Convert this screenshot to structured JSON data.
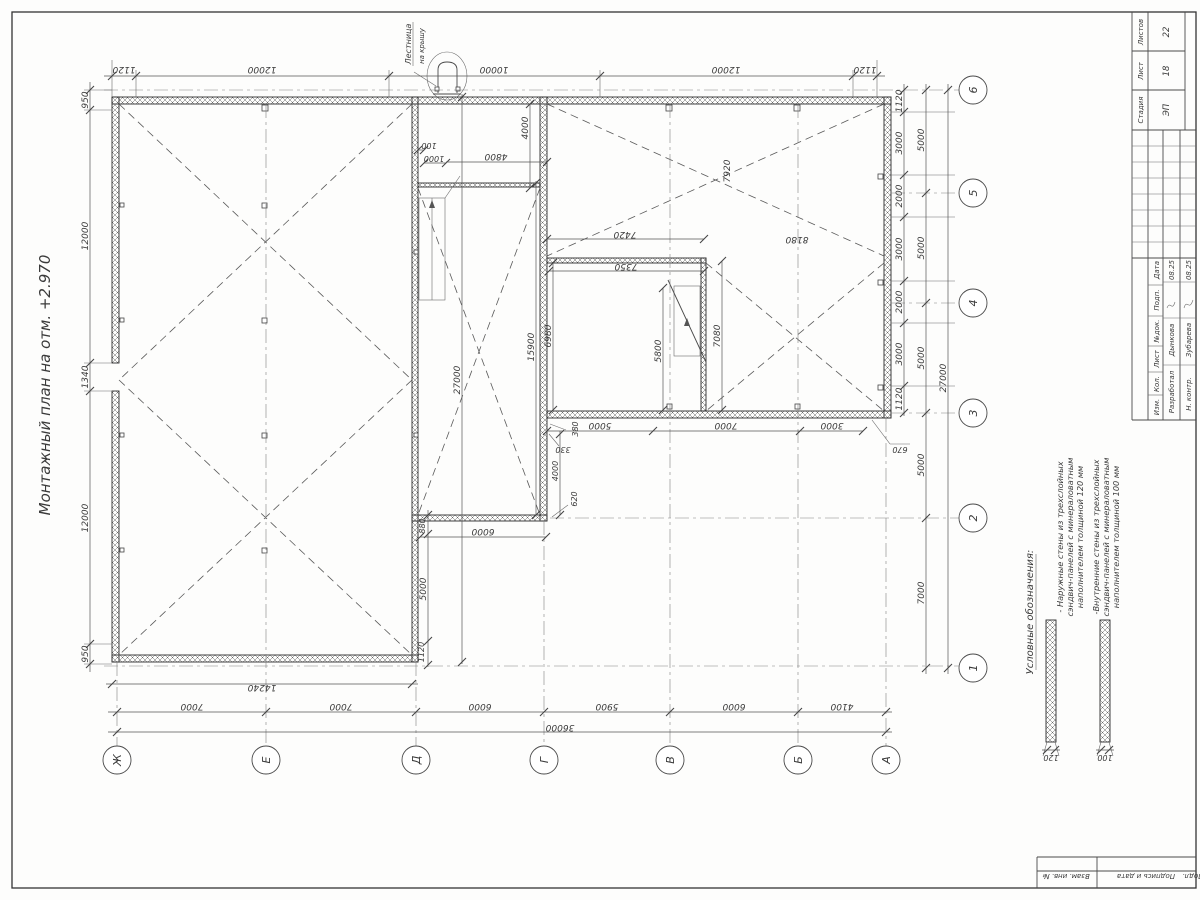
{
  "sheet": {
    "title": "Монтажный план на отм. +2.970"
  },
  "ladder": {
    "line1": "Лестница",
    "line2": "на крышу"
  },
  "axes": {
    "bottom": [
      "Ж",
      "Е",
      "Д",
      "Г",
      "В",
      "Б",
      "А"
    ],
    "right": [
      "6",
      "5",
      "4",
      "3",
      "2",
      "1"
    ]
  },
  "dims": {
    "top": [
      "1120",
      "12000",
      "10000",
      "12000",
      "1120"
    ],
    "left": [
      "950",
      "12000",
      "1340",
      "12000",
      "950"
    ],
    "right_inner": [
      "1120",
      "3000",
      "2000",
      "3000",
      "2000",
      "3000",
      "1120"
    ],
    "right_mid": [
      "5000",
      "5000",
      "5000",
      "5000",
      "7000"
    ],
    "right_total": "27000",
    "hall_width": "14240",
    "bottom_axes": [
      "7000",
      "7000",
      "6000",
      "5900",
      "6000",
      "4100"
    ],
    "bottom_total": "36000",
    "strip": {
      "t100": "100",
      "t1000": "1000",
      "t4800": "4800",
      "t4000": "4000",
      "total_v": "27000",
      "right_v": "15900"
    },
    "strip_bottom": {
      "t880": "880",
      "t6000": "6000",
      "t5000": "5000",
      "t1120": "1120",
      "t620": "620",
      "t4000": "4000",
      "t330": "330",
      "t380": "380"
    },
    "rooms": {
      "t7420": "7420",
      "t7350": "7350",
      "t6980": "6980",
      "t5800": "5800",
      "t7080": "7080",
      "t7920": "7920",
      "t8180": "8180"
    },
    "below3": [
      "5000",
      "7000",
      "3000"
    ],
    "t670": "670",
    "legend": [
      "120",
      "100"
    ]
  },
  "legend": {
    "heading": "Условные обозначения:",
    "item1": {
      "l1": "- Наружные стены из трехслойных",
      "l2": "сэндвич-панелей с минераловатным",
      "l3": "наполнителем толщиной 120 мм"
    },
    "item2": {
      "l1": "-Внутренние стены из трехслойных",
      "l2": "сэндвич-панелей с минераловатным",
      "l3": "наполнителем толщиной 100 мм"
    }
  },
  "stamp": {
    "stadia_label": "Стадия",
    "list_label": "Лист",
    "listov_label": "Листов",
    "stadia": "ЭП",
    "list": "18",
    "listov": "22",
    "h_izm": "Изм.",
    "h_kol": "Кол.",
    "h_list": "Лист",
    "h_ndok": "№док.",
    "h_podp": "Подп.",
    "h_data": "Дата",
    "r1_role": "Разработал",
    "r1_name": "Дынкова",
    "r1_date": "08.25",
    "r2_role": "Н. контр.",
    "r2_name": "Зубарева",
    "r2_date": "08.25",
    "side1": "Взам. инв. №",
    "side2": "Подпись и дата",
    "side3": "Подл."
  }
}
